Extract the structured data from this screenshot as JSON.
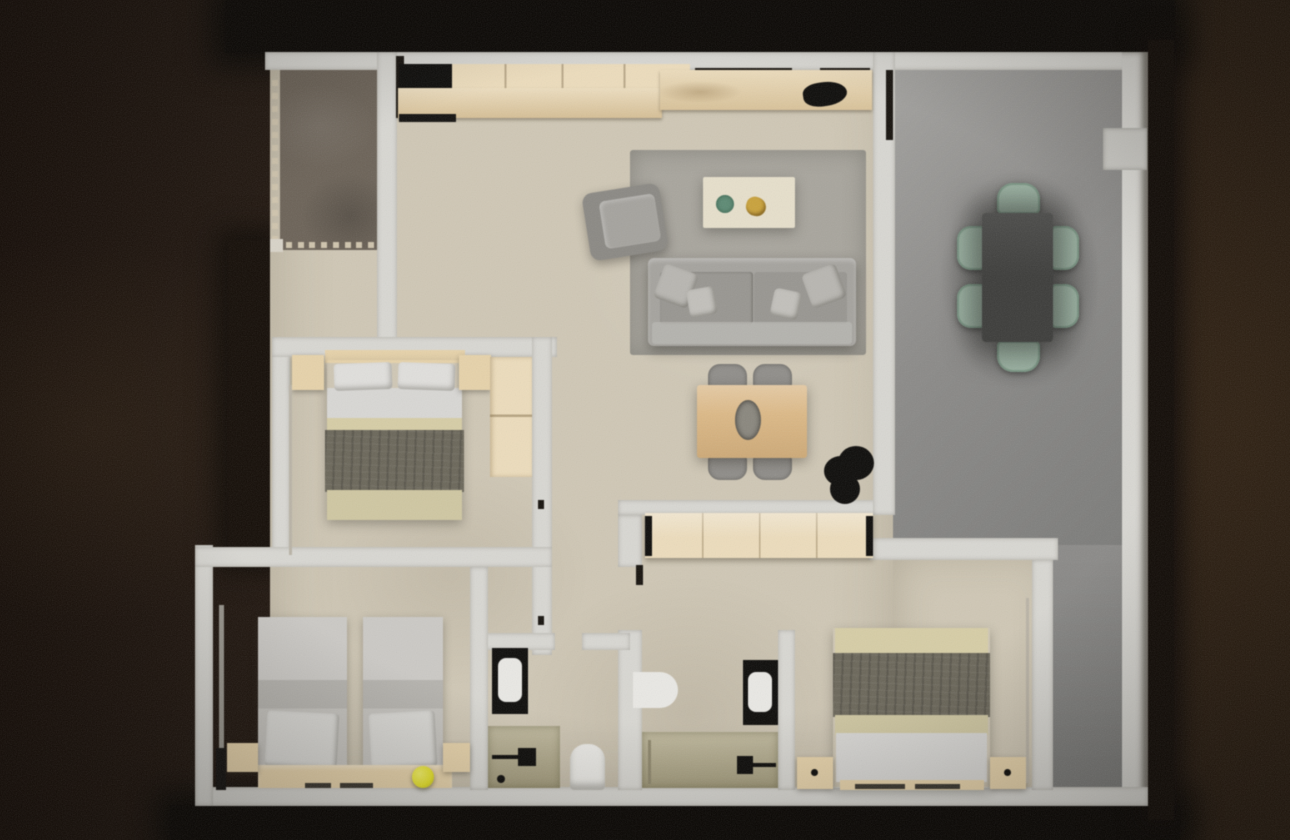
{
  "scene": {
    "type": "floor-plan-3d-render",
    "view": "top-down",
    "text_content": "none",
    "rooms": [
      {
        "name": "balcony",
        "floor": "dark-brown",
        "features": [
          "dotted-balustrade-left",
          "dotted-balustrade-bottom"
        ]
      },
      {
        "name": "kitchen",
        "furniture": [
          "refrigerator",
          "upper-cabinets",
          "counter",
          "cooktop"
        ]
      },
      {
        "name": "living-dining-room",
        "furniture": [
          "rug",
          "armchair",
          "coffee-table",
          "decor-bowl",
          "decor-gold",
          "sofa",
          "sofa-pillows",
          "dining-table",
          "dining-chairs",
          "plant"
        ]
      },
      {
        "name": "terrace",
        "floor": "gray",
        "furniture": [
          "outdoor-dining-table",
          "outdoor-chairs",
          "wall-unit"
        ]
      },
      {
        "name": "bedroom-1",
        "furniture": [
          "double-bed",
          "nightstands",
          "wardrobe"
        ]
      },
      {
        "name": "bedroom-2",
        "furniture": [
          "single-bed-left",
          "single-bed-right",
          "nightstands",
          "headboard-bench",
          "radiator",
          "yellow-ball"
        ]
      },
      {
        "name": "bedroom-3",
        "furniture": [
          "double-bed",
          "nightstands"
        ]
      },
      {
        "name": "bathroom-1",
        "furniture": [
          "vanity-sink",
          "shower",
          "toilet"
        ]
      },
      {
        "name": "bathroom-2",
        "furniture": [
          "vanity-sink",
          "shower",
          "bath-mat"
        ]
      },
      {
        "name": "hallway",
        "furniture": [
          "built-in-wardrobe"
        ]
      }
    ],
    "counts": {
      "dining_chairs_indoor": 4,
      "outdoor_chairs": 6,
      "single_beds": 2,
      "double_beds": 2,
      "bathrooms": 2,
      "sofa_pillows": 4
    }
  },
  "balustrade": {
    "left_dots": 13,
    "bottom_dots": 8
  },
  "palette": {
    "wall": "#d8d7d2",
    "floor": "#cfc7b5",
    "balcony": "#6c6358",
    "terrace": "#8c8b89",
    "terrace-light": "#a3a29f",
    "terrace-dark": "#7c7c7a",
    "rug": "#a8a59d",
    "sofa": "#a5a39e",
    "sofa-dark": "#8b8984",
    "sofa-seat": "#989691",
    "cushion": "#b8b6b1",
    "cream": "#e6dfcb",
    "wood": "#e6d2aa",
    "wood-light": "#ecdcbc",
    "wood-mid": "#dcb987",
    "olive": "#6b675a",
    "bed-beige": "#d6cda6",
    "bed-foot": "#cfc7a2",
    "bed-white": "#d8d7d4",
    "charcoal": "#3d3d3b",
    "sage": "#9db4a4",
    "sage-dark": "#7e9a88",
    "gray-chair": "#908e8a",
    "shower": "#b4ac8d",
    "porcelain": "#e9e8e4",
    "black": "#0e0d0b",
    "yellow": "#e6e22b",
    "green-bowl": "#5d8a74",
    "gold": "#c9a23c",
    "vase": "#8a877e",
    "dot": "#cfc4ad"
  }
}
